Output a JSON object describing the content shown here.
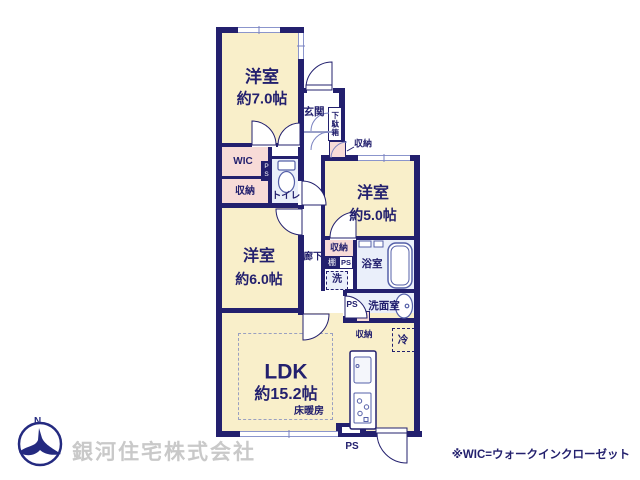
{
  "plan": {
    "rooms": {
      "western7": {
        "name": "洋室",
        "size": "約7.0帖"
      },
      "western5": {
        "name": "洋室",
        "size": "約5.0帖"
      },
      "western6": {
        "name": "洋室",
        "size": "約6.0帖"
      },
      "ldk": {
        "name": "LDK",
        "size": "約15.2帖"
      }
    },
    "labels": {
      "entrance": "玄関",
      "shoe_cabinet": "下駄箱",
      "storage": "収納",
      "wic": "WIC",
      "toilet": "トイレ",
      "corridor": "廊下",
      "shelf": "棚",
      "washer": "洗",
      "bathroom": "浴室",
      "washroom": "洗面室",
      "refrigerator": "冷",
      "floor_heating": "床暖房",
      "ps": "PS"
    }
  },
  "footer": {
    "company": "銀河住宅株式会社",
    "note": "※WIC=ウォークインクローゼット"
  },
  "colors": {
    "wall_navy": "#23206e",
    "room_cream": "#f9efca",
    "closet_pink": "#f7dbd7",
    "wet_area_blue": "#eaeffa",
    "company_gray": "#c9c9c9"
  }
}
